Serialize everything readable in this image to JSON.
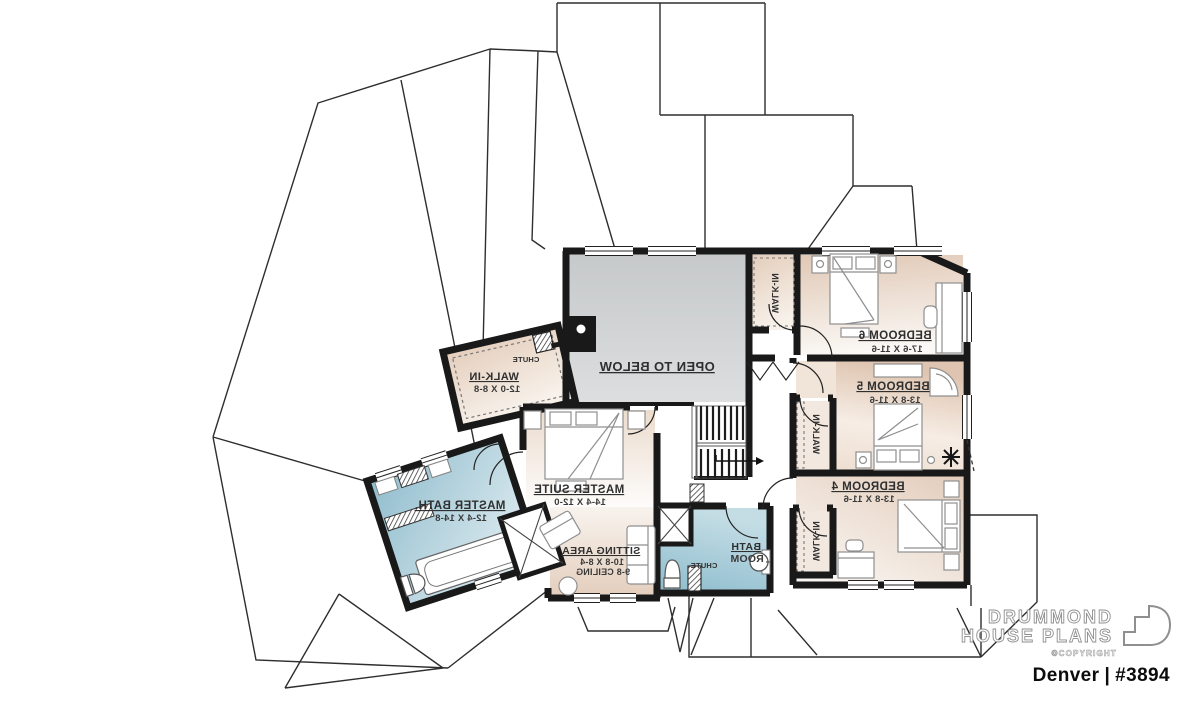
{
  "plan": {
    "rooms": {
      "open_to_below": {
        "name": "OPEN TO BELOW"
      },
      "master_suite": {
        "name": "MASTER SUITE",
        "dims": "14-4 X 12-0"
      },
      "master_walkin": {
        "name": "WALK-IN",
        "dims": "12-0 X 8-8"
      },
      "master_bath": {
        "name": "MASTER BATH.",
        "dims": "12-4 X 14-8"
      },
      "sitting_area": {
        "name": "SITTING AREA",
        "dims": "10-8 X 8-4",
        "note": "9-8 CEILING"
      },
      "bath_room": {
        "line1": "BATH",
        "line2": "ROOM"
      },
      "bedroom6": {
        "name": "BEDROOM 6",
        "dims": "17-6 X 11-6"
      },
      "bedroom5": {
        "name": "BEDROOM 5",
        "dims": "13-8 X 11-6"
      },
      "bedroom4": {
        "name": "BEDROOM 4",
        "dims": "13-8 X 11-6"
      },
      "walkin_bedroom6": {
        "name": "WALK-IN"
      },
      "walkin_bedroom5": {
        "name": "WALK-IN"
      },
      "walkin_bedroom4": {
        "name": "WALK-IN"
      },
      "chute_master": {
        "name": "CHUTE"
      },
      "chute_bath": {
        "name": "CHUTE"
      }
    },
    "colors": {
      "wall": "#191919",
      "roof_line": "#2e2e2e",
      "bedroom_fill_dark": "#e0c8b5",
      "bath_fill_dark": "#8fbccd",
      "open_below_fill": "#c9cccd",
      "label_text": "#2f2f2f"
    }
  },
  "branding": {
    "line1": "DRUMMOND",
    "line2": "HOUSE PLANS",
    "copyright": "©COPYRIGHT",
    "plan_name": "Denver",
    "separator": "|",
    "plan_number": "#3894"
  }
}
